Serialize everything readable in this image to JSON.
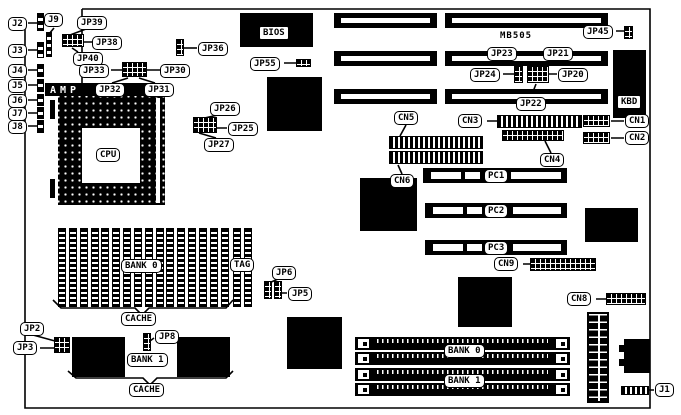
{
  "diagram_type": "motherboard-jumper-connector-diagram",
  "board_silkscreen": "MB505",
  "labels": {
    "j1": "J1",
    "j2": "J2",
    "j3": "J3",
    "j4": "J4",
    "j5": "J5",
    "j6": "J6",
    "j7": "J7",
    "j8": "J8",
    "j9": "J9",
    "jp2": "JP2",
    "jp3": "JP3",
    "jp5": "JP5",
    "jp6": "JP6",
    "jp8": "JP8",
    "jp20": "JP20",
    "jp21": "JP21",
    "jp22": "JP22",
    "jp23": "JP23",
    "jp24": "JP24",
    "jp25": "JP25",
    "jp26": "JP26",
    "jp27": "JP27",
    "jp30": "JP30",
    "jp31": "JP31",
    "jp32": "JP32",
    "jp33": "JP33",
    "jp36": "JP36",
    "jp38": "JP38",
    "jp39": "JP39",
    "jp40": "JP40",
    "jp45": "JP45",
    "jp55": "JP55",
    "cn1": "CN1",
    "cn2": "CN2",
    "cn3": "CN3",
    "cn4": "CN4",
    "cn5": "CN5",
    "cn6": "CN6",
    "cn8": "CN8",
    "cn9": "CN9",
    "pc1": "PC1",
    "pc2": "PC2",
    "pc3": "PC3",
    "cpu": "CPU",
    "bios": "BIOS",
    "amp": "AMP",
    "kbd": "KBD",
    "tag": "TAG",
    "bank0_cache": "BANK 0",
    "bank1_cache": "BANK 1",
    "cache_top": "CACHE",
    "cache_bottom": "CACHE",
    "bank0_simm": "BANK 0",
    "bank1_simm": "BANK 1"
  },
  "colors": {
    "ink": "#000000",
    "paper": "#ffffff"
  }
}
